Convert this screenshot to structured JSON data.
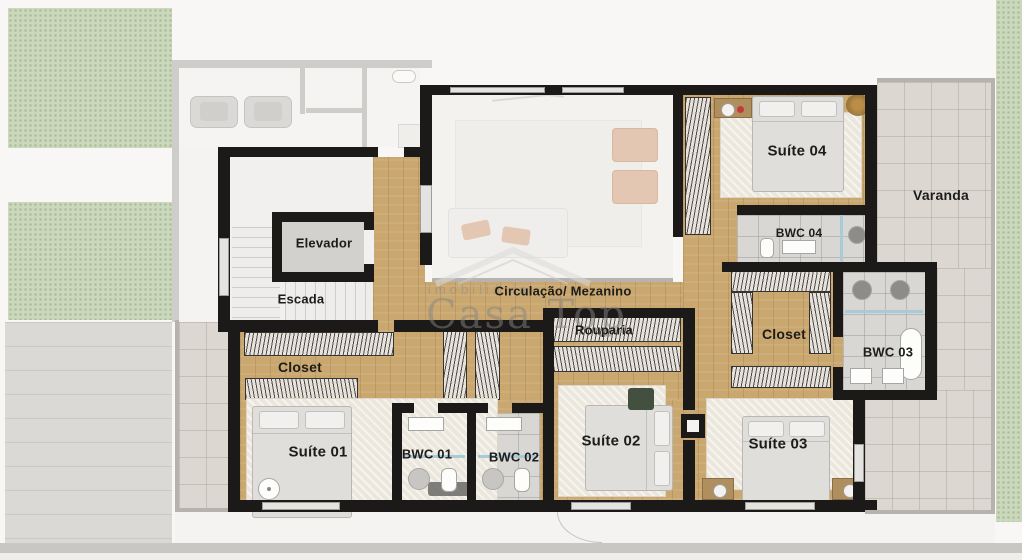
{
  "plan_title": "Upper floor residential plan",
  "watermark": {
    "brand_prefix": "imobiliária",
    "brand": "Casa Top"
  },
  "rooms": {
    "elevador": {
      "label": "Elevador"
    },
    "escada": {
      "label": "Escada"
    },
    "circulacao": {
      "label": "Circulação/ Mezanino"
    },
    "rouparia": {
      "label": "Rouparia"
    },
    "closet_suite01": {
      "label": "Closet"
    },
    "suite01": {
      "label": "Suíte 01"
    },
    "bwc01": {
      "label": "BWC 01"
    },
    "bwc02": {
      "label": "BWC 02"
    },
    "suite02": {
      "label": "Suíte 02"
    },
    "suite03": {
      "label": "Suíte 03"
    },
    "closet_suite03": {
      "label": "Closet"
    },
    "bwc03": {
      "label": "BWC 03"
    },
    "bwc04": {
      "label": "BWC 04"
    },
    "suite04": {
      "label": "Suíte 04"
    },
    "varanda": {
      "label": "Varanda"
    }
  },
  "palette": {
    "wall": "#1b1a18",
    "wood_floor": "#C9A76F",
    "bath_tile": "#D8D7D4",
    "varanda_tile": "#DCD8D1",
    "garden_green": "#CBD8BD",
    "pavement": "#DAD9D6",
    "rug": "#ECE7DC",
    "glass_blue": "#A9CBD8",
    "chair_accent": "#D8A481",
    "watermark_gray": "#868583",
    "label_text": "#1d1c1b"
  }
}
